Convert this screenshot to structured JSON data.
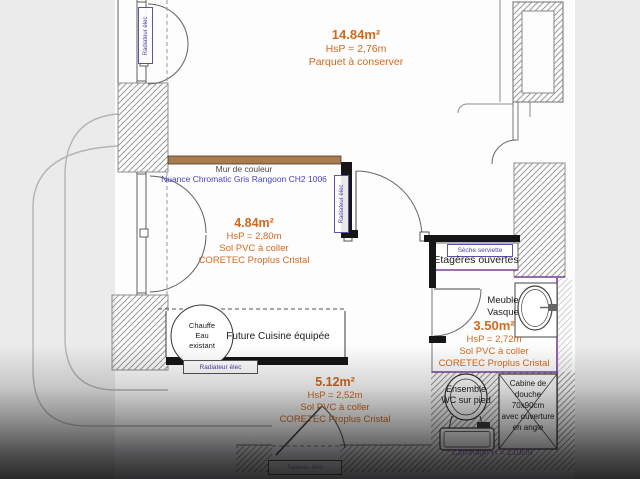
{
  "colors": {
    "accent_orange": "#d2691e",
    "accent_blue": "#4444bb",
    "accent_purple": "#7d3c98",
    "wall_brown": "#a87c52",
    "wall_black": "#161616",
    "background": "#ebebeb"
  },
  "living": {
    "area": "14.84m²",
    "hsp": "HsP = 2,76m",
    "note": "Parquet à conserver"
  },
  "wall_note": {
    "title": "Mur de couleur",
    "ref": "Nuance Chromatic Gris Rangoon CH2 1006"
  },
  "kitchen": {
    "area": "4.84m²",
    "hsp": "HsP = 2,80m",
    "sol": "Sol PVC à coller",
    "brand": "CORETEC Proplus Cristal",
    "cuisine": "Future Cuisine équipée",
    "chauffe": "Chauffe\nEau\nexistant"
  },
  "bathroom": {
    "area": "3.50m²",
    "hsp": "HsP = 2,72m",
    "sol": "Sol PVC à coller",
    "brand": "CORETEC Proplus Cristal",
    "seche": "Sèche serviette",
    "etageres": "Etagères ouvertes",
    "vasque": "Meuble\nVasque",
    "wc": "Ensemble\nWC sur pied",
    "cabine": "Cabine de\ndouche\n70x90cm\navec ouverture\nen angle",
    "carrelage": "Carrelage H = 210cm"
  },
  "hallway": {
    "area": "5.12m²",
    "hsp": "HsP = 2,52m",
    "sol": "Sol PVC à coller",
    "brand": "CORETEC Proplus Cristal",
    "tableau": "Tableau élec"
  },
  "equipment": {
    "radiateur": "Radiateur élec"
  }
}
